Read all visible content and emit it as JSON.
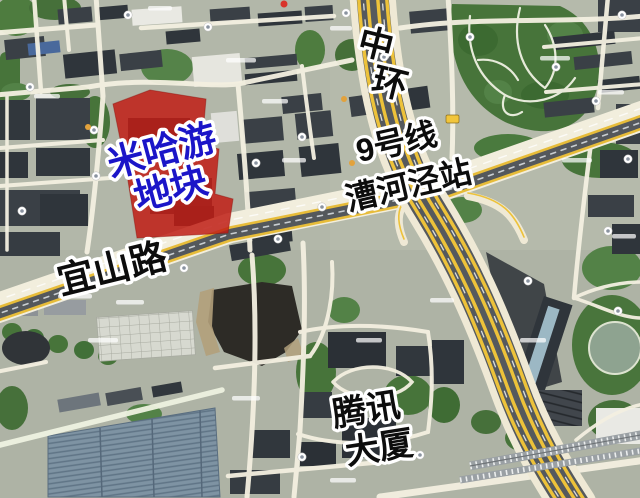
{
  "annotations": {
    "plot": {
      "line1": "米哈游",
      "line2": "地块"
    },
    "ring_road": {
      "char1": "中",
      "char2": "环"
    },
    "metro": {
      "line": "9号线",
      "station": "漕河泾站"
    },
    "road": {
      "name": "宜山路"
    },
    "tencent": {
      "line1": "腾讯",
      "line2": "大厦"
    }
  },
  "colors": {
    "plot_fill": "#c01d15",
    "plot_text": "#1b15c8",
    "annotation_text": "#0c0c0c",
    "annotation_outline": "#ffffff",
    "highway_yellow": "#edc23a",
    "road_surface": "#f2eedd",
    "rail_dark": "#54585c",
    "vegetation_green": "#4e7c3f",
    "building_dark": "#3a4046",
    "ground_base": "#b2b7a9"
  }
}
